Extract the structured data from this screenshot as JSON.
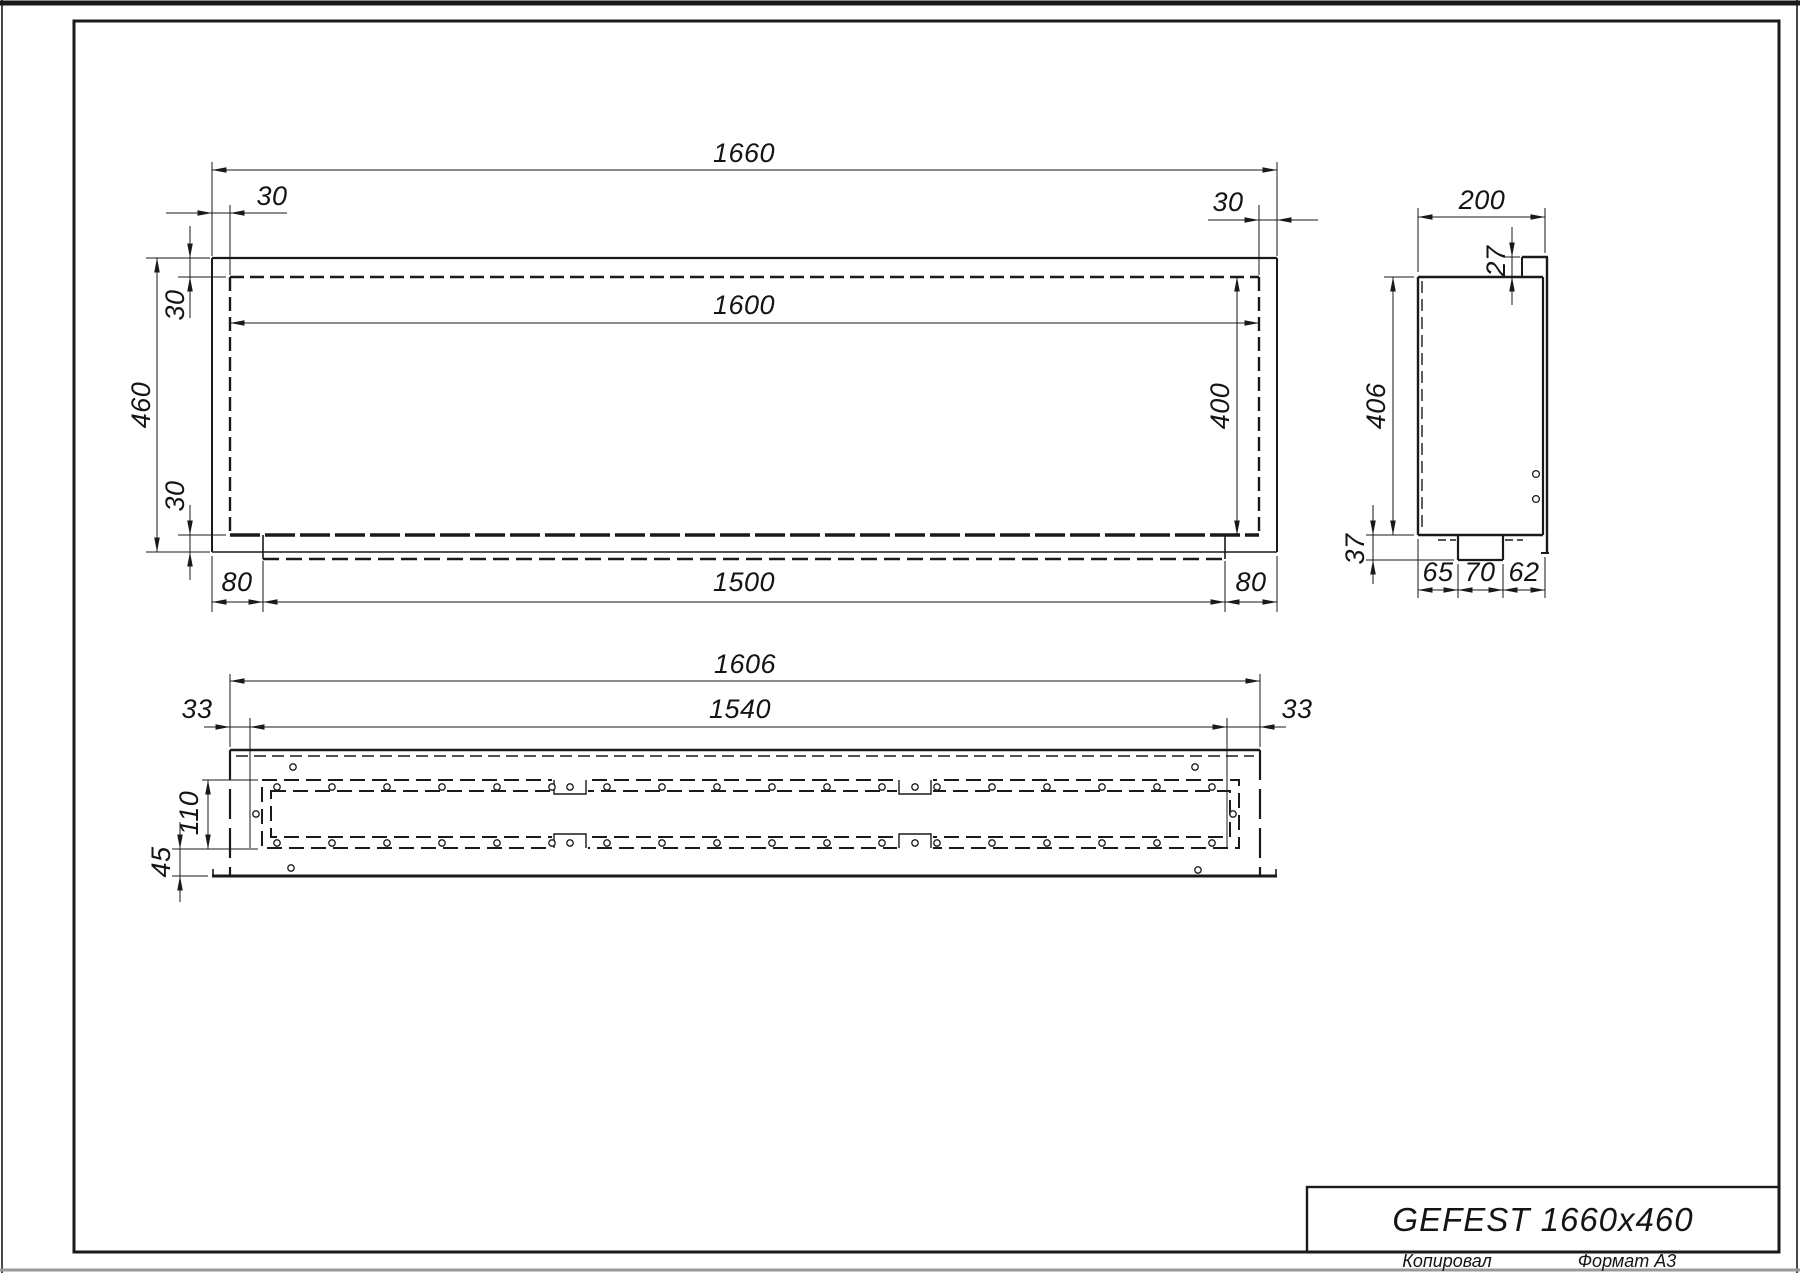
{
  "page": {
    "background": "#ffffff",
    "ink": "#1a1a1a",
    "copied_label": "Копировал",
    "format_label": "Формат А3"
  },
  "title_block": {
    "title": "GEFEST 1660x460"
  },
  "front_view": {
    "dims": {
      "overall_width": "1660",
      "top_offset_left": "30",
      "top_offset_right": "30",
      "opening_width": "1600",
      "frame_top": "30",
      "frame_bottom": "30",
      "overall_height": "460",
      "opening_height": "400",
      "bottom_left": "80",
      "bottom_center": "1500",
      "bottom_right": "80"
    }
  },
  "side_view": {
    "dims": {
      "depth": "200",
      "top_lip": "27",
      "height": "406",
      "bottom_drop": "37",
      "bottom_left": "65",
      "bottom_center": "70",
      "bottom_right": "62"
    }
  },
  "bottom_view": {
    "dims": {
      "overall_width": "1606",
      "inner_width": "1540",
      "margin_left": "33",
      "margin_right": "33",
      "band_height": "110",
      "bottom_margin": "45"
    },
    "holes": {
      "radius": 3.2,
      "band_rows": [
        {
          "y": 787,
          "x_start": 277,
          "x_end": 1212,
          "count": 18
        },
        {
          "y": 843,
          "x_start": 277,
          "x_end": 1212,
          "count": 18
        }
      ],
      "single_holes": [
        [
          256,
          814
        ],
        [
          1233,
          814
        ],
        [
          293,
          767
        ],
        [
          291,
          868
        ],
        [
          1195,
          767
        ],
        [
          1198,
          870
        ],
        [
          570,
          787
        ],
        [
          570,
          843
        ],
        [
          915,
          787
        ],
        [
          915,
          843
        ]
      ]
    }
  }
}
